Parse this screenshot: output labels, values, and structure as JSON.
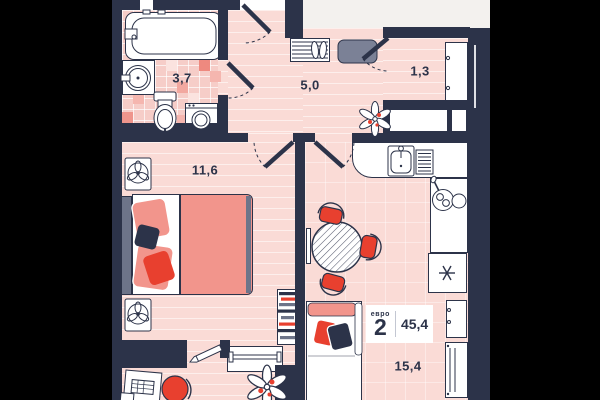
{
  "plan": {
    "badge": {
      "type_label": "евро",
      "type_value": "2",
      "total_area": "45,4"
    },
    "rooms": [
      {
        "id": "bathroom",
        "area": "3,7"
      },
      {
        "id": "hallway",
        "area": "5,0"
      },
      {
        "id": "closet",
        "area": "1,3"
      },
      {
        "id": "bedroom",
        "area": "11,6"
      },
      {
        "id": "living-kitchen",
        "area": "15,4"
      }
    ],
    "colors": {
      "wall": "#2c3349",
      "floor": "#fadbd6",
      "tile_dark": "#ef958c",
      "accent_red": "#e8402f",
      "accent_salmon": "#f2958c",
      "slate": "#6d7489",
      "outside": "#f3f1ee",
      "margin": "#000000",
      "badge_bg": "#ffffff"
    }
  }
}
